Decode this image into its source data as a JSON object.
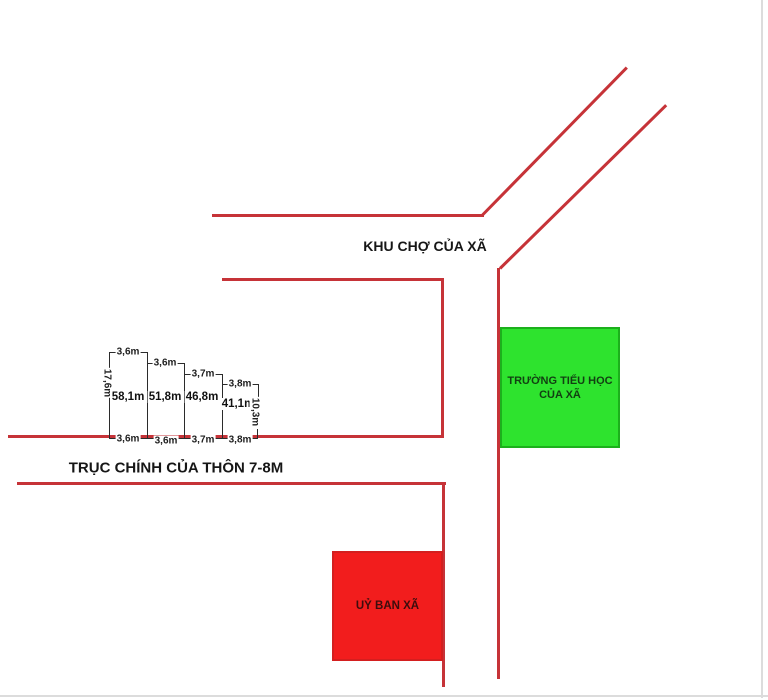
{
  "diagram_title": "land plot site sketch",
  "labels": {
    "market_area": "KHU CHỢ CỦA XÃ",
    "main_road": "TRỤC CHÍNH CỦA THÔN 7-8M",
    "school_line1": "TRƯỜNG TIỂU HỌC",
    "school_line2": "CỦA XÃ",
    "committee": "UỶ BAN XÃ"
  },
  "plots": {
    "top_widths": [
      "3,6m",
      "3,6m",
      "3,7m",
      "3,8m"
    ],
    "bottom_widths": [
      "3,6m",
      "3,6m",
      "3,7m",
      "3,8m"
    ],
    "areas": [
      "58,1m",
      "51,8m",
      "46,8m",
      "41,1m"
    ],
    "left_depth": "17,6m",
    "right_depth": "10,3m"
  },
  "colors": {
    "road_red": "#c63338",
    "dimension_black": "#2b2b2b",
    "school_fill": "#2ee32e",
    "school_border": "#1cb01c",
    "school_text": "#124012",
    "committee_fill": "#f21d1d",
    "committee_border": "#d41f1f",
    "committee_text": "#3d0d0d",
    "background": "#ffffff"
  }
}
